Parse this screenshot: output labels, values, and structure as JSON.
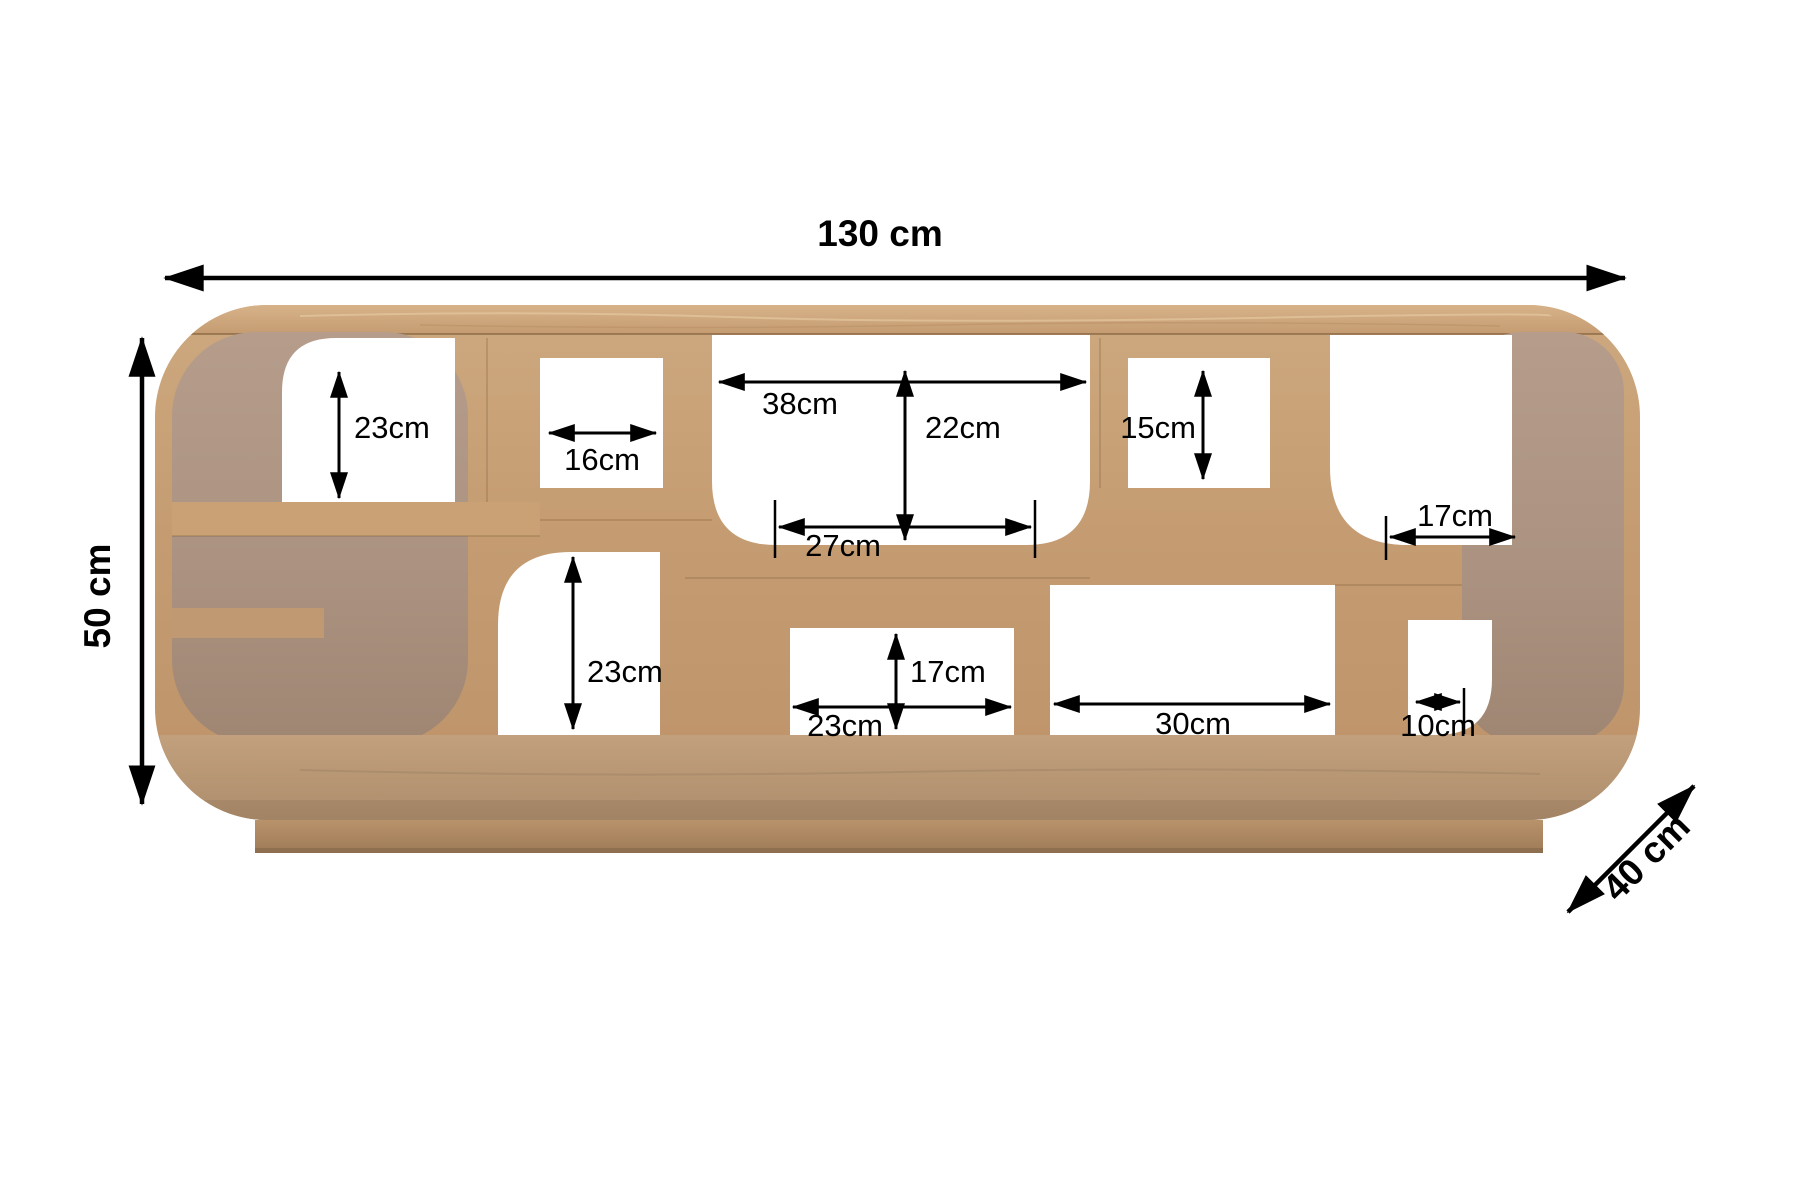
{
  "diagram": {
    "background_color": "#ffffff",
    "line_color": "#000000",
    "wood_colors": {
      "face": "#c9a077",
      "top_surface": "#d0a97f",
      "inner_surface": "#b29885",
      "floor": "#b7997a",
      "plinth": "#ae8a63"
    },
    "overall_dimensions": {
      "width": "130 cm",
      "height": "50 cm",
      "depth": "40 cm"
    },
    "inner_dimensions": {
      "top_left_height": "23cm",
      "top_cube_width": "16cm",
      "center_width": "38cm",
      "center_height": "22cm",
      "right_cube_height": "15cm",
      "center_shelf_width": "27cm",
      "right_shelf_width": "17cm",
      "lower_left_height": "23cm",
      "lower_center_height": "17cm",
      "lower_center_width": "23cm",
      "lower_right_width": "30cm",
      "lower_corner_width": "10cm"
    }
  }
}
